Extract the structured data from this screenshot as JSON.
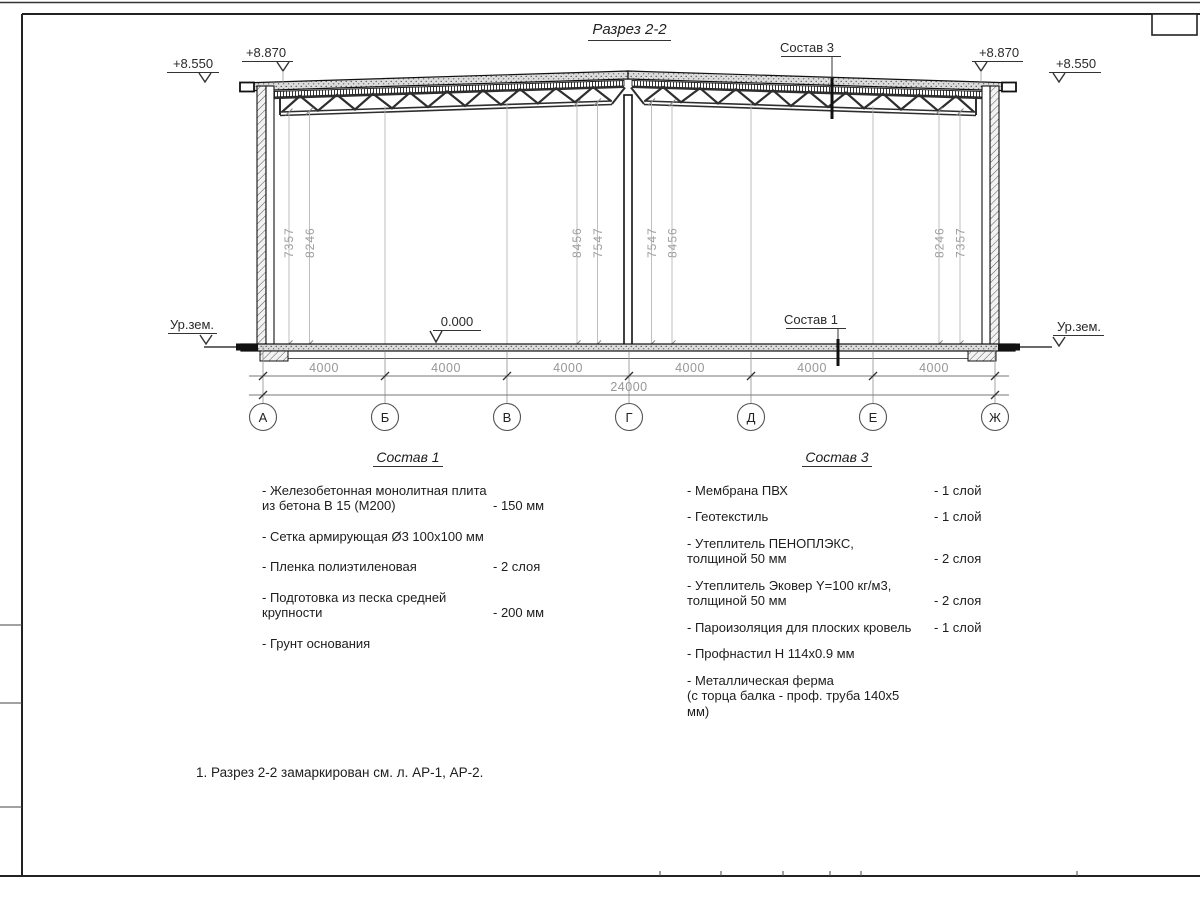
{
  "title": "Разрез 2-2",
  "marks": {
    "elev_left_outer": "+8.550",
    "elev_left_inner": "+8.870",
    "elev_right_inner": "+8.870",
    "elev_right_outer": "+8.550",
    "ground_left": "Ур.зем.",
    "ground_right": "Ур.зем.",
    "zero_level": "0.000",
    "roof_callout": "Состав 3",
    "floor_callout": "Состав 1"
  },
  "vertical_dims": [
    "7357",
    "8246",
    "8456",
    "7547",
    "7547",
    "8456",
    "8246",
    "7357"
  ],
  "bottom_dims": {
    "bays": [
      "4000",
      "4000",
      "4000",
      "4000",
      "4000",
      "4000"
    ],
    "total": "24000"
  },
  "axes": [
    "А",
    "Б",
    "В",
    "Г",
    "Д",
    "Е",
    "Ж"
  ],
  "comp1": {
    "title": "Состав 1",
    "items": [
      {
        "name": "- Железобетонная  монолитная плита\nиз бетона В 15 (М200)",
        "value": "- 150 мм"
      },
      {
        "name": "- Сетка армирующая Ø3 100х100 мм",
        "value": ""
      },
      {
        "name": "- Пленка полиэтиленовая",
        "value": "-  2 слоя"
      },
      {
        "name": "- Подготовка из песка средней\nкрупности",
        "value": "- 200 мм"
      },
      {
        "name": "- Грунт основания",
        "value": ""
      }
    ]
  },
  "comp3": {
    "title": "Состав 3",
    "items": [
      {
        "name": "- Мембрана ПВХ",
        "value": "- 1 слой"
      },
      {
        "name": "- Геотекстиль",
        "value": "- 1 слой"
      },
      {
        "name": "- Утеплитель ПЕНОПЛЭКС,\nтолщиной 50 мм",
        "value": "- 2 слоя"
      },
      {
        "name": "- Утеплитель Эковер Y=100 кг/м3,\nтолщиной 50 мм",
        "value": "- 2 слоя"
      },
      {
        "name": "- Пароизоляция для плоских кровель",
        "value": "- 1 слой"
      },
      {
        "name": "- Профнастил Н 114х0.9 мм",
        "value": ""
      },
      {
        "name": "- Металлическая ферма\n(с торца балка - проф. труба 140х5 мм)",
        "value": ""
      }
    ]
  },
  "note": "1. Разрез 2-2 замаркирован см. л. АР-1, АР-2."
}
